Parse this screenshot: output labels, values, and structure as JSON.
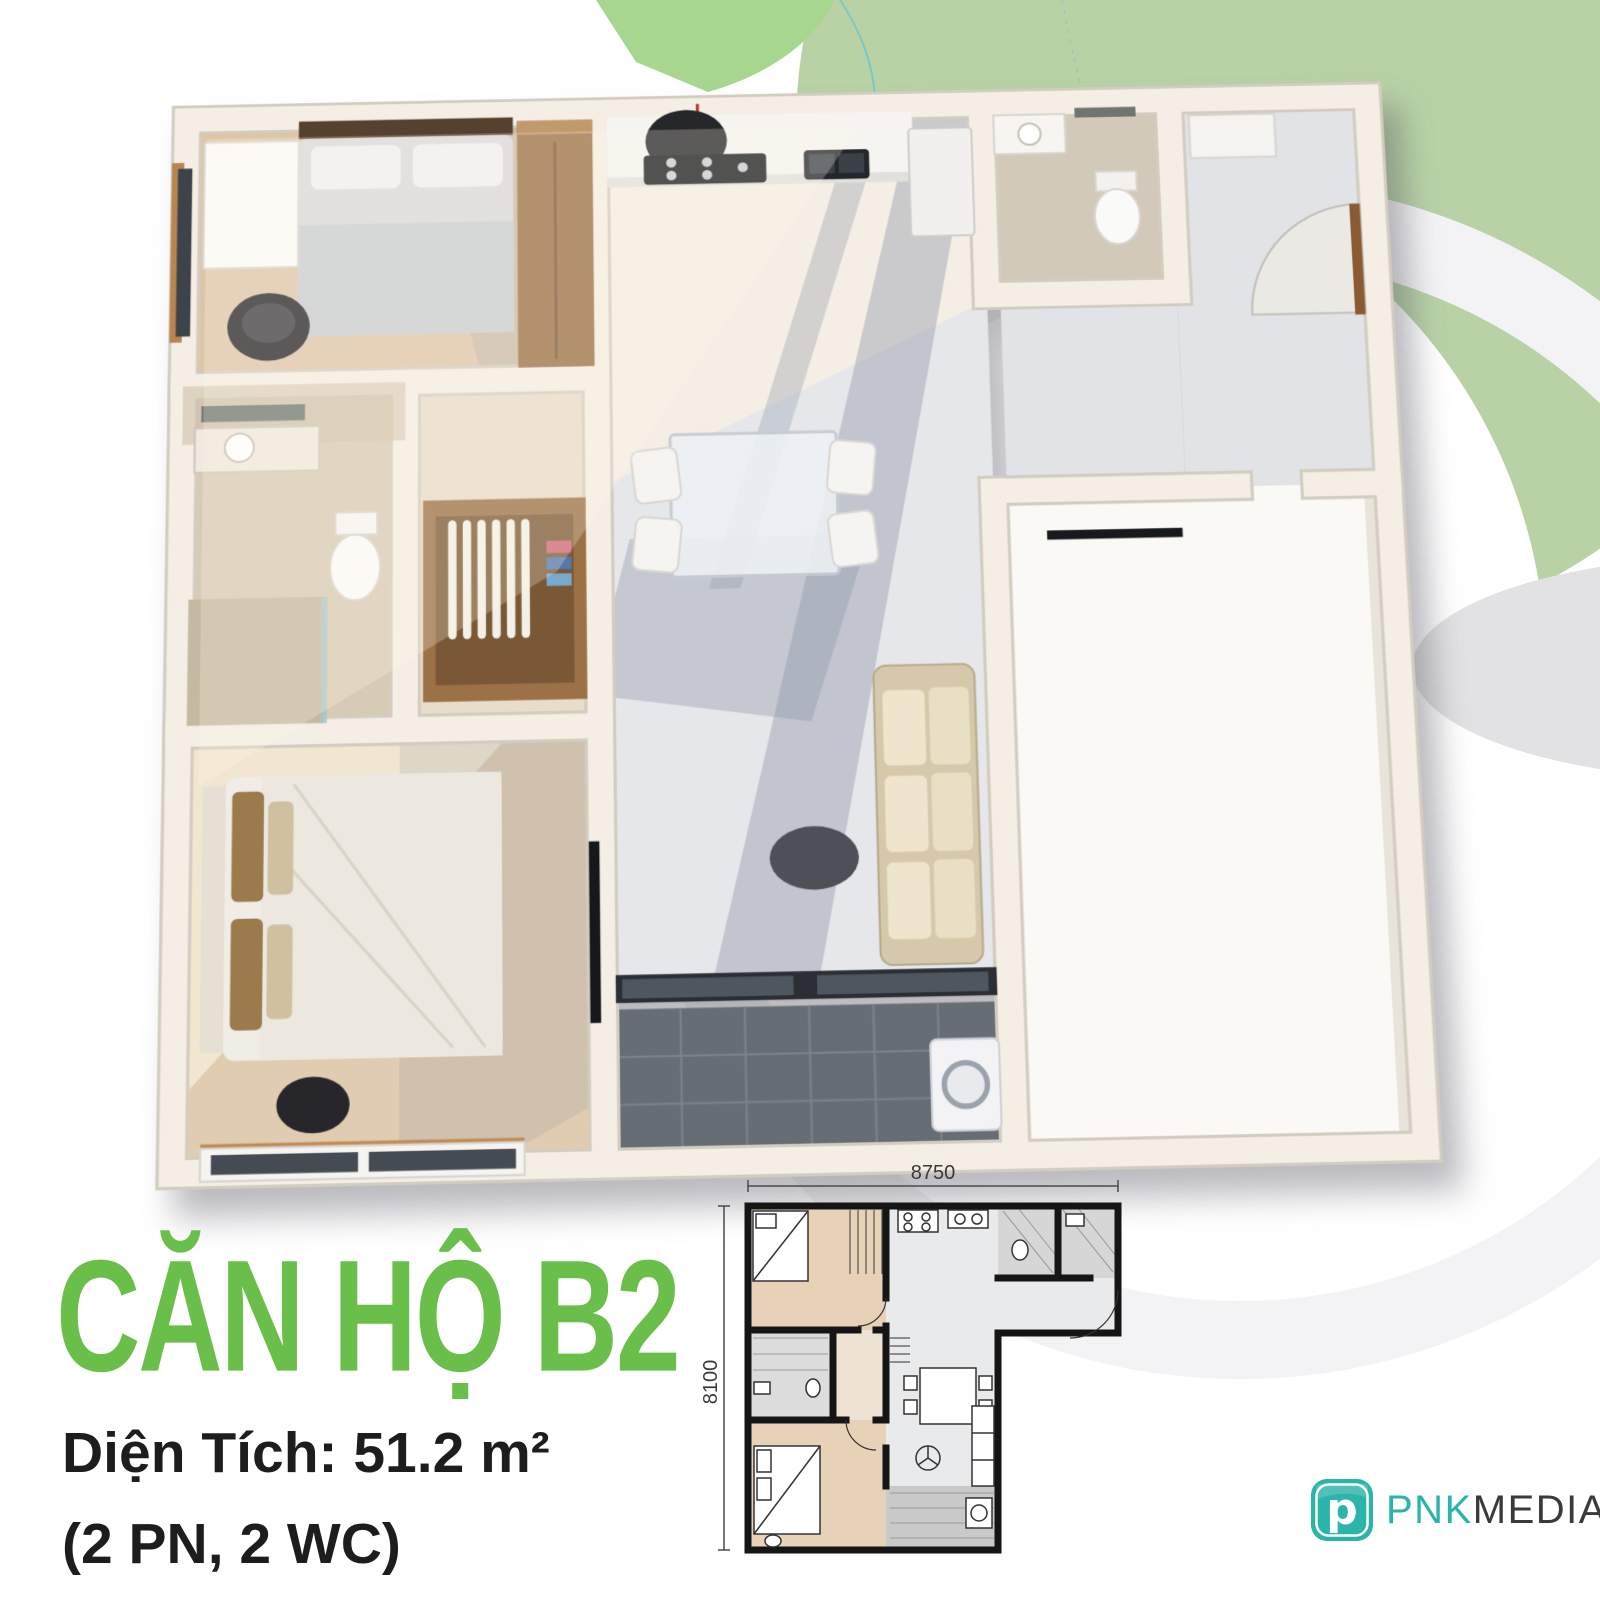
{
  "poster": {
    "title": "CĂN HỘ B2",
    "area_label": "Diện Tích: 51.2 m²",
    "rooms_label": "(2 PN, 2 WC)"
  },
  "plan": {
    "width_mm": "8750",
    "height_mm": "8100"
  },
  "logo": {
    "icon_letter": "p",
    "brand_primary": "PNK",
    "brand_secondary": "MEDIA"
  },
  "colors": {
    "title_green": "#6abf4b",
    "logo_teal": "#2bb4a9",
    "bg_circle_green": "#b8d2a6",
    "bg_arc_green": "#a7d78e",
    "text_dark": "#1d1d1b"
  }
}
